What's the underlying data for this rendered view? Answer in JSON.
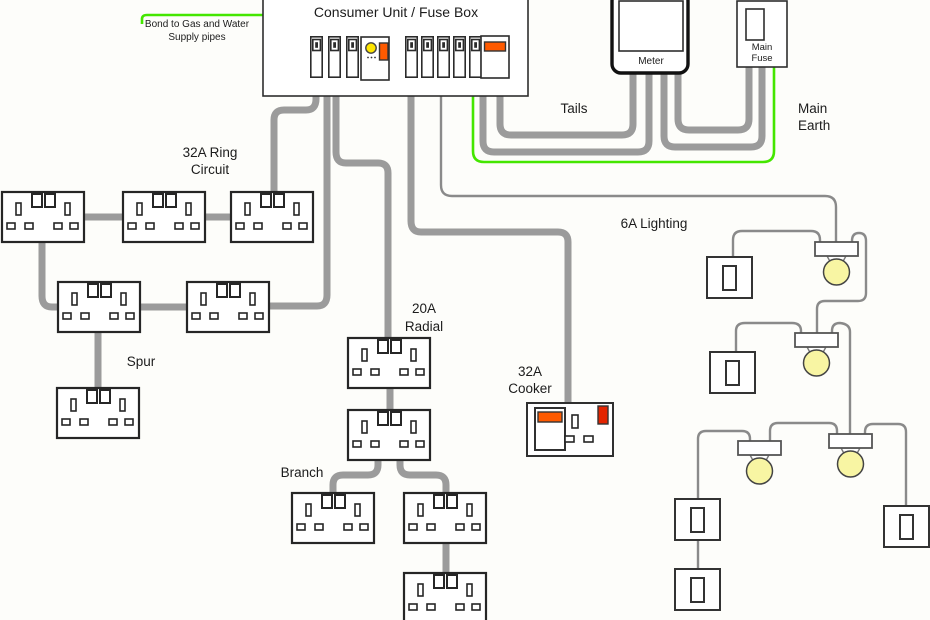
{
  "diagram_title": "Consumer Unit / Fuse Box",
  "labels": {
    "bond_line1": "Bond to Gas and Water",
    "bond_line2": "Supply pipes",
    "meter": "Meter",
    "main_fuse_line1": "Main",
    "main_fuse_line2": "Fuse",
    "tails": "Tails",
    "main_earth_line1": "Main",
    "main_earth_line2": "Earth",
    "ring_line1": "32A Ring",
    "ring_line2": "Circuit",
    "lighting": "6A Lighting",
    "spur": "Spur",
    "radial_line1": "20A",
    "radial_line2": "Radial",
    "cooker_line1": "32A",
    "cooker_line2": "Cooker",
    "branch": "Branch"
  },
  "colors": {
    "paper": "#fdfdfa",
    "ink": "#1c1c1c",
    "box_stroke": "#2e2e2e",
    "wire_gray": "#9b9b9b",
    "wire_thin": "#8a8a8a",
    "earth_green": "#44e600",
    "bulb_yellow": "#f8f5a3",
    "switch_orange": "#ff5a00",
    "indicator_red": "#e32400",
    "rcd_yellow": "#ffe600"
  }
}
